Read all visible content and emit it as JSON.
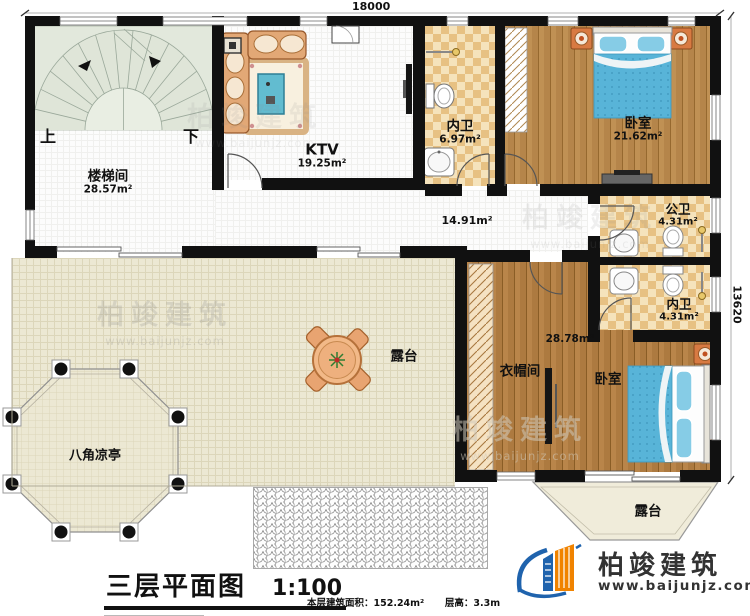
{
  "dimensions": {
    "width_label": "18000",
    "height_label": "13620"
  },
  "rooms": {
    "stair": {
      "name": "楼梯间",
      "area": "28.57m²",
      "up": "上",
      "down": "下"
    },
    "ktv": {
      "name": "KTV",
      "area": "19.25m²"
    },
    "bath_top": {
      "name": "内卫",
      "area": "6.97m²"
    },
    "bedroom_top": {
      "name": "卧室",
      "area": "21.62m²"
    },
    "corridor": {
      "area": "14.91m²"
    },
    "public_bath": {
      "name": "公卫",
      "area": "4.31m²"
    },
    "bath_right": {
      "name": "内卫",
      "area": "4.31m²"
    },
    "bedroom_bottom": {
      "name": "卧室",
      "area": "28.78m²"
    },
    "cloakroom": {
      "name": "衣帽间"
    },
    "terrace_main": {
      "name": "露台"
    },
    "terrace_bay": {
      "name": "露台"
    },
    "pavilion": {
      "name": "八角凉亭"
    }
  },
  "title": {
    "main": "三层平面图",
    "scale": "1:100",
    "area_info": "本层建筑面积：152.24m²",
    "height_info": "层高：3.3m"
  },
  "logo": {
    "name": "柏竣建筑",
    "site": "www.baijunjz.com"
  },
  "watermark": {
    "name": "柏竣建筑",
    "site": "www.baijunjz.com"
  },
  "colors": {
    "wall": "#111111",
    "wood": "#b5854a",
    "checker_light": "#f5e3bc",
    "checker_dark": "#e7c183",
    "terrace": "#ece8d3",
    "bed_blue": "#58b4d8",
    "furniture_orange": "#d87a42",
    "logo_blue": "#1f63ad",
    "logo_orange": "#f08300"
  }
}
